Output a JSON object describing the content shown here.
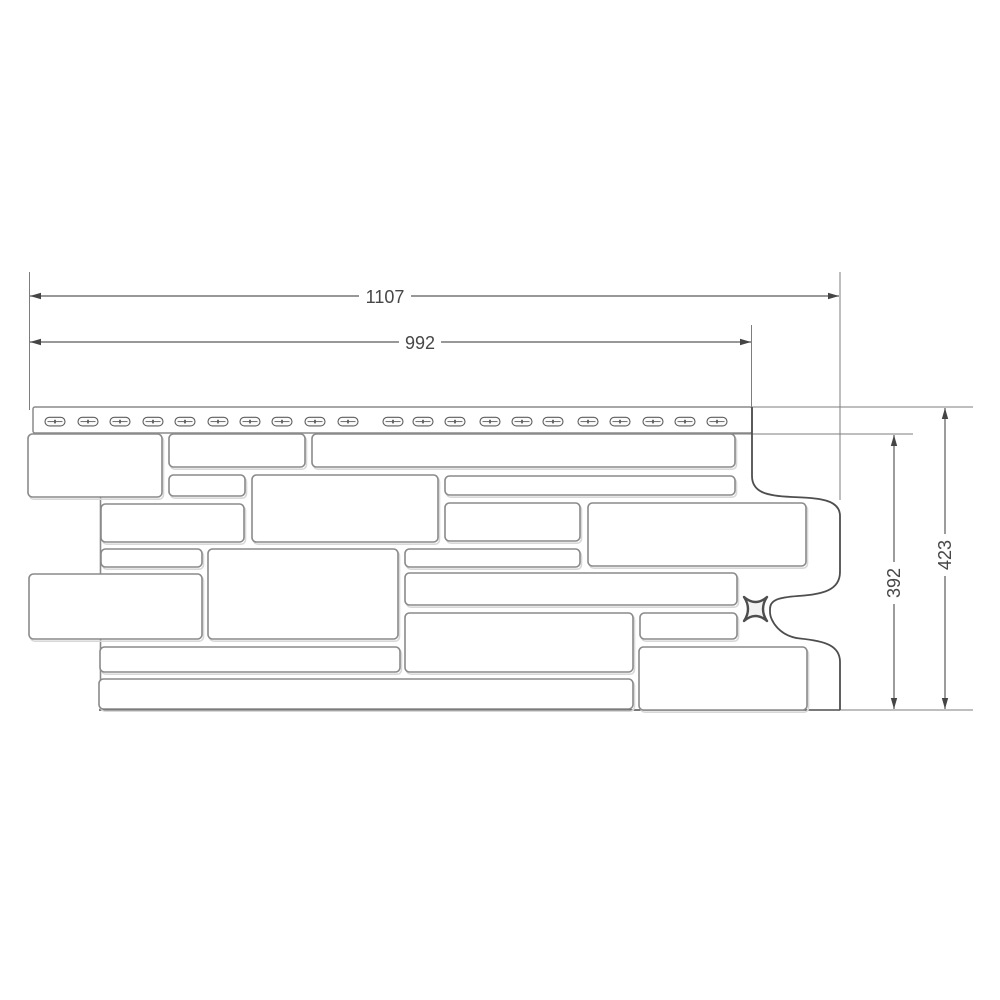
{
  "drawing": {
    "background": "#ffffff",
    "colors": {
      "stone_outline": "#8a8a8a",
      "stone_fill": "#ffffff",
      "stone_shadow": "#d8d8d8",
      "panel_outline": "#4e4e4e",
      "hem_outline": "#8a8a8a",
      "hem_fill": "#ffffff",
      "slot_outline": "#5e5e5e",
      "slot_fill": "#fbfbfb",
      "extension_line": "#7d7d7d",
      "dimension_line": "#5a5a5a",
      "arrow": "#454545",
      "label_text": "#474747"
    },
    "label_font_size": 18,
    "panel": {
      "nail_hem": {
        "x": 33,
        "y": 407,
        "width": 719,
        "height": 26,
        "corner_radius": 2
      },
      "nail_slots": {
        "y": 417.3,
        "width": 20,
        "height": 8.6,
        "x_positions": [
          45,
          78,
          110,
          143,
          175,
          208,
          240,
          272,
          305,
          338,
          383,
          413,
          445,
          480,
          512,
          543,
          578,
          610,
          643,
          675,
          707
        ]
      },
      "right_contour_path": "M 752,407 L 752,476 C 752,492 766,496 792,497 C 818,498 840,499 840,516 L 840,572 C 840,590 823,594.5 798,596 C 778,597.5 770,600 770,609 L 770,612 C 770,621 780,636.5 800,638.5 C 824,641 840,645 840,662 L 840,710",
      "left_edge": {
        "x": 100.5,
        "y1": 497,
        "y2": 709
      },
      "bottom_edge": {
        "y": 710,
        "x1": 99,
        "x2": 840
      },
      "clip_mark_path": "M744,597 Q755.5,607 767,597 Q759,609 767,621 Q755.5,611 744,621 Q752,609 744,597 Z",
      "stones": [
        [
          28,
          434,
          134,
          63
        ],
        [
          169,
          434,
          136,
          33
        ],
        [
          312,
          434,
          423,
          33
        ],
        [
          169,
          475,
          76,
          21
        ],
        [
          252,
          475,
          186,
          67
        ],
        [
          445,
          476,
          290,
          19
        ],
        [
          101,
          504,
          143,
          38
        ],
        [
          445,
          503,
          135,
          38
        ],
        [
          588,
          503,
          218,
          63
        ],
        [
          101,
          549,
          101,
          18
        ],
        [
          405,
          549,
          175,
          18
        ],
        [
          208,
          549,
          190,
          90
        ],
        [
          29,
          574,
          173,
          65
        ],
        [
          405,
          573,
          332,
          32
        ],
        [
          405,
          613,
          228,
          59
        ],
        [
          640,
          613,
          97,
          26
        ],
        [
          100,
          647,
          300,
          25
        ],
        [
          639,
          647,
          168,
          63
        ],
        [
          99,
          679,
          534,
          30
        ]
      ]
    },
    "dimensions": [
      {
        "name": "overall-width",
        "value": "1107",
        "axis": "x",
        "line_y": 296,
        "from": 30,
        "to": 839,
        "label_x": 385,
        "label_y": 297
      },
      {
        "name": "exposed-width",
        "value": "992",
        "axis": "x",
        "line_y": 342,
        "from": 30,
        "to": 751,
        "label_x": 420,
        "label_y": 343
      },
      {
        "name": "exposed-height",
        "value": "392",
        "axis": "y",
        "line_x": 894,
        "from": 435,
        "to": 709,
        "label_x": 894,
        "label_y": 583
      },
      {
        "name": "overall-height",
        "value": "423",
        "axis": "y",
        "line_x": 945,
        "from": 408,
        "to": 709,
        "label_x": 945,
        "label_y": 555
      }
    ],
    "extension_lines": [
      {
        "x1": 29.5,
        "y1": 272,
        "x2": 29.5,
        "y2": 410
      },
      {
        "x1": 840,
        "y1": 272,
        "x2": 840,
        "y2": 500
      },
      {
        "x1": 751.5,
        "y1": 325,
        "x2": 751.5,
        "y2": 410
      },
      {
        "x1": 752,
        "y1": 407,
        "x2": 973,
        "y2": 407
      },
      {
        "x1": 713,
        "y1": 434,
        "x2": 913,
        "y2": 434
      },
      {
        "x1": 99,
        "y1": 710,
        "x2": 973,
        "y2": 710
      }
    ]
  }
}
